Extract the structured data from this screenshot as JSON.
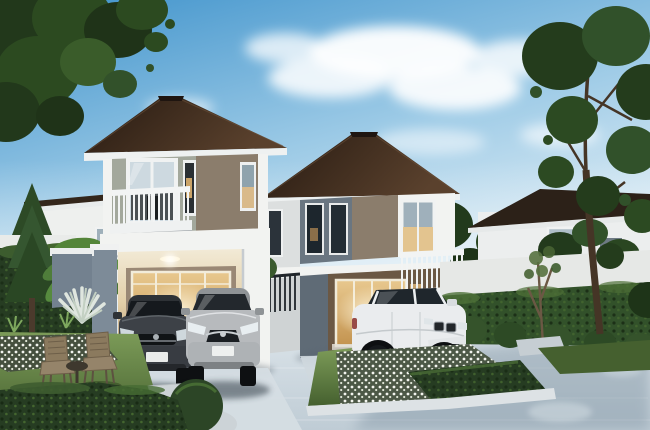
{
  "scene": {
    "description": "3D architectural rendering of two modern two-storey detached houses with a dark hipped roof, carports with parked cars, landscaped hedges, flower beds and a concrete driveway under a blue sky",
    "palette": {
      "sky_top": "#3e92cb",
      "sky_mid": "#9ccae6",
      "sky_horizon": "#e6f1f7",
      "cloud_white": "#ffffff",
      "roof_dark_brown": "#271a11",
      "roof_highlight": "#5a412d",
      "fascia_white": "#eef1f1",
      "wall_white": "#f2f3f1",
      "wall_gray_green": "#a3a89c",
      "wall_taupe": "#8b7d6c",
      "wall_blue_gray": "#6a7681",
      "wall_shadow_blue": "#7d8b98",
      "glass_cool": "#cdd9e0",
      "glass_dark": "#20272c",
      "warm_light": "#e8c88e",
      "warm_deep": "#c3934f",
      "foliage_dark": "#22381b",
      "foliage_mid": "#32512a",
      "foliage_light": "#4e7334",
      "banana_green": "#5d9044",
      "grass_light": "#7c9b58",
      "grass_dark": "#45602f",
      "hedge_dark": "#263c22",
      "driveway_light": "#dfe7ec",
      "driveway_mid": "#bfccd5",
      "driveway_shadow": "#7f93a2",
      "stone_pale": "#d3d8da",
      "car_dark": "#3d4147",
      "car_silver": "#b7babd",
      "car_white": "#eaecee",
      "wicker_tan": "#8b7a5e",
      "trunk_brown": "#4b3a2c",
      "fence_dark": "#20262b"
    },
    "objects": {
      "sky": {
        "label": "Blue sky fading to pale horizon"
      },
      "clouds": {
        "label": "Soft white clouds"
      },
      "tree_canopy": {
        "label": "Overhanging tree canopy, top left"
      },
      "background_house_left": {
        "label": "White neighbouring house behind trees, left"
      },
      "background_house_right": {
        "label": "Grey and white neighbouring house behind fence, right"
      },
      "house_left": {
        "label": "Front two-storey house with balcony and double carport"
      },
      "house_right": {
        "label": "Second two-storey house with corner windows and balcony"
      },
      "car_hatchback": {
        "label": "Dark grey hatchback parked in carport"
      },
      "car_sedan": {
        "label": "Silver sedan parked in carport"
      },
      "car_suv": {
        "label": "White SUV parked on the driveway"
      },
      "hedges": {
        "label": "Clipped green hedges"
      },
      "flower_beds": {
        "label": "White flower beds with stone curbs"
      },
      "garden_chairs": {
        "label": "Two wicker garden chairs with side table"
      },
      "driveway": {
        "label": "Light concrete driveway with tree shadows"
      },
      "tall_tree": {
        "label": "Tall tree on the right"
      },
      "palm": {
        "label": "Fan palm and banana plants beside the left house"
      }
    }
  }
}
